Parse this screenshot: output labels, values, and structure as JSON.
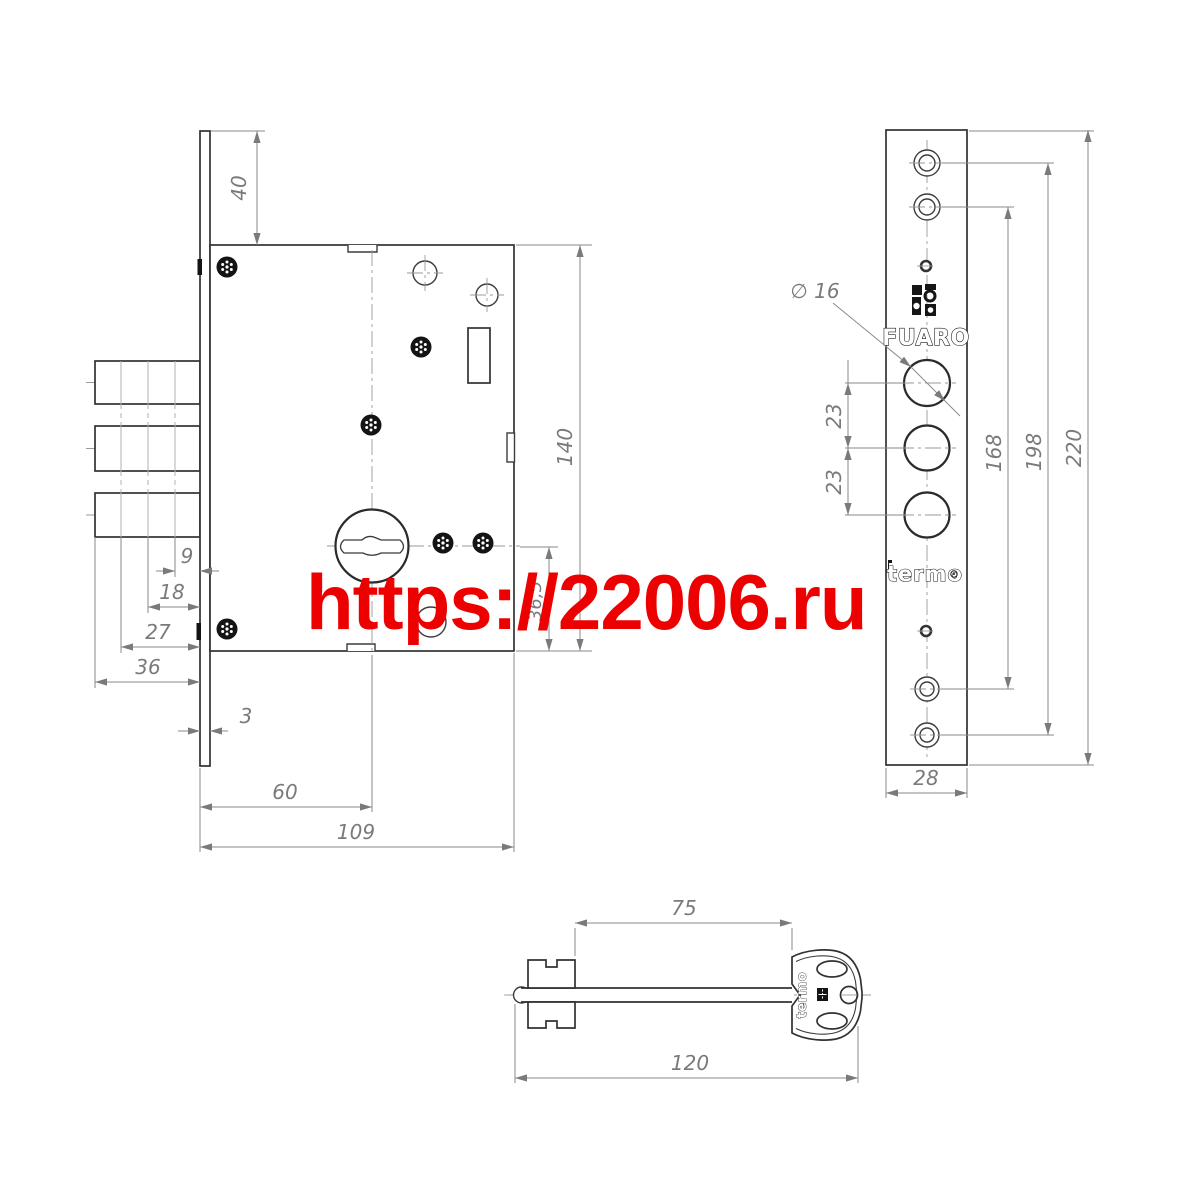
{
  "watermark": {
    "text": "https://22006.ru",
    "color": "#ed0000"
  },
  "main_view": {
    "dims": {
      "offset_top": "40",
      "height": "140",
      "cylinder_offset": "36,5",
      "step1": "9",
      "step2": "18",
      "step3": "27",
      "bolt_depth": "36",
      "plate_thickness": "3",
      "backset": "60",
      "depth": "109"
    }
  },
  "faceplate_view": {
    "brand": {
      "logo": "FUARO",
      "series": "termo",
      "emblem_icon": "fuaro-grid-emblem"
    },
    "dims": {
      "hole_diameter": "∅ 16",
      "pitch_upper": "23",
      "pitch_lower": "23",
      "span_inner": "168",
      "span_outer": "198",
      "height": "220",
      "width": "28"
    }
  },
  "key_view": {
    "label": "termo",
    "dims": {
      "shaft": "75",
      "total": "120"
    }
  }
}
